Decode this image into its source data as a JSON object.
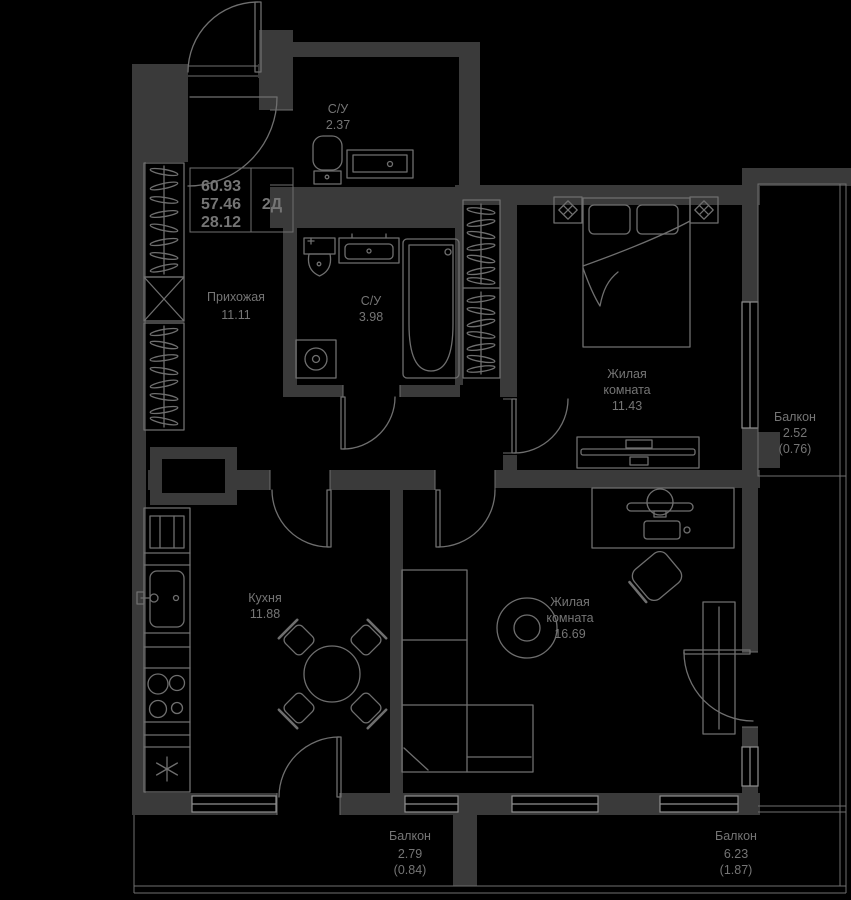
{
  "info_box": {
    "values": [
      "60.93",
      "57.46",
      "28.12"
    ],
    "type_label": "2Д"
  },
  "rooms": {
    "hallway": {
      "name": "Прихожая",
      "area": "11.11"
    },
    "bathroom_top": {
      "name": "С/У",
      "area": "2.37"
    },
    "bathroom_main": {
      "name": "С/У",
      "area": "3.98"
    },
    "bedroom": {
      "name_line1": "Жилая",
      "name_line2": "комната",
      "area": "11.43"
    },
    "kitchen": {
      "name": "Кухня",
      "area": "11.88"
    },
    "living_room": {
      "name_line1": "Жилая",
      "name_line2": "комната",
      "area": "16.69"
    },
    "balcony_right": {
      "name": "Балкон",
      "area": "2.52",
      "coeff_area": "(0.76)"
    },
    "balcony_bottom_left": {
      "name": "Балкон",
      "area": "2.79",
      "coeff_area": "(0.84)"
    },
    "balcony_bottom_right": {
      "name": "Балкон",
      "area": "6.23",
      "coeff_area": "(1.87)"
    }
  },
  "colors": {
    "bg": "#000000",
    "wall": "#3a3a3a",
    "line": "#6f6f6f",
    "window": "#8f8f8f",
    "text": "#757575"
  }
}
